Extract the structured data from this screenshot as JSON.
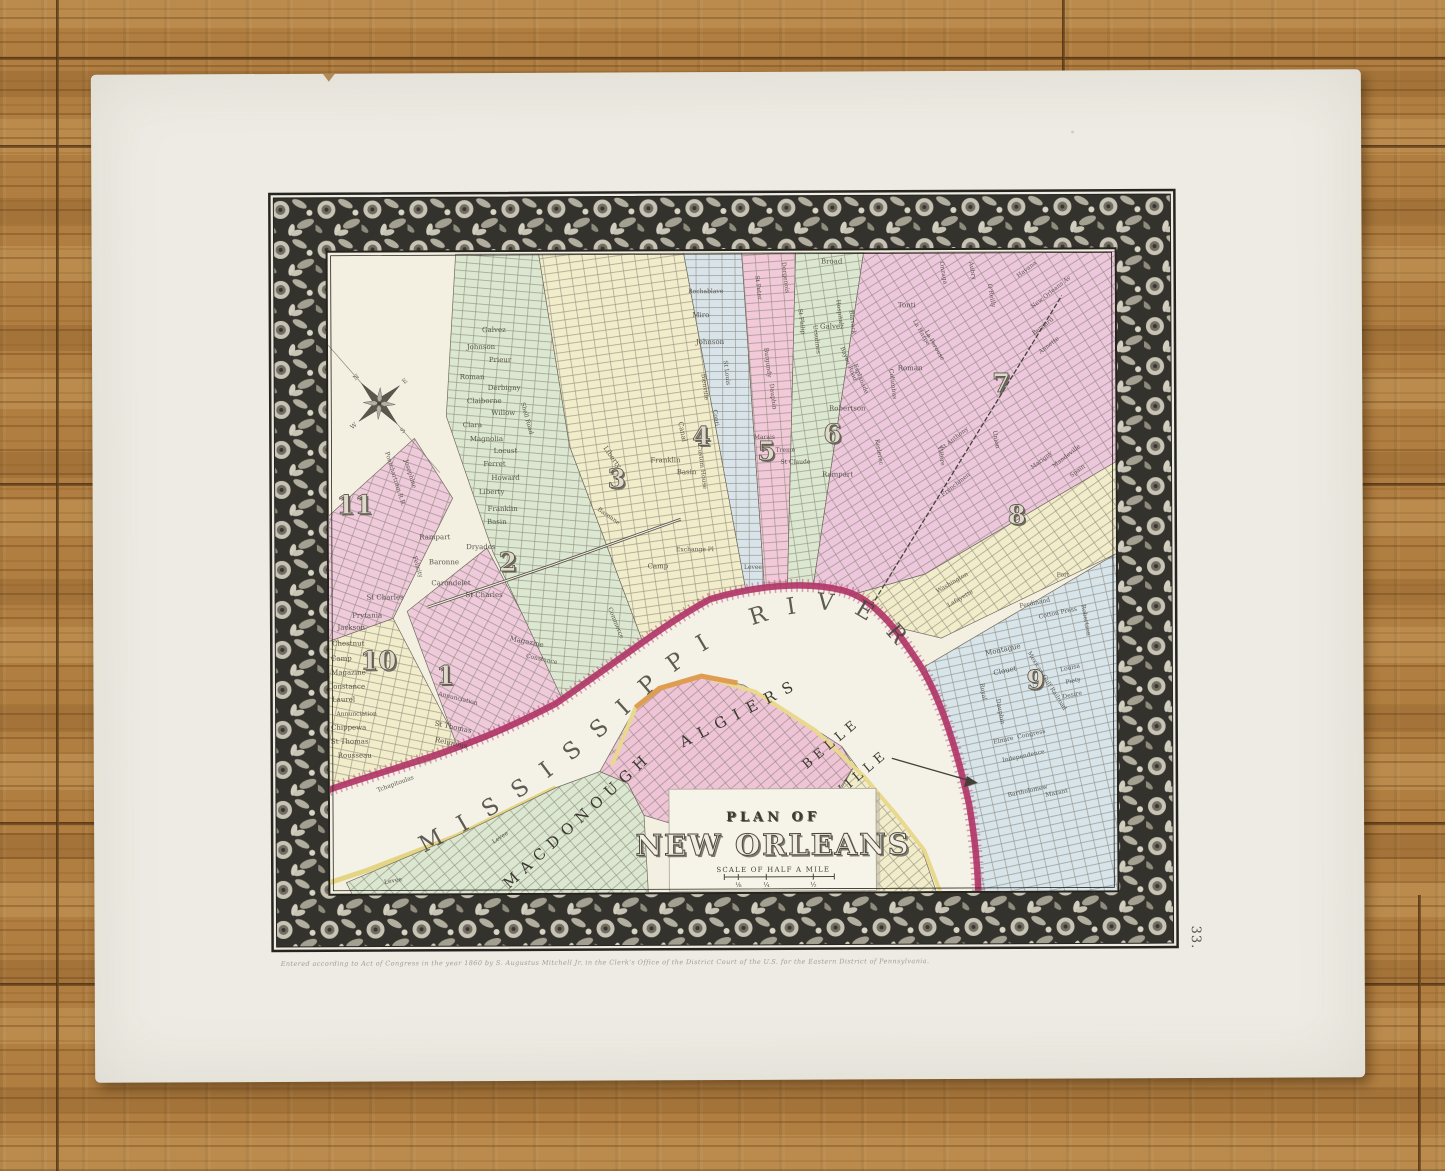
{
  "page": {
    "plate_number": "33.",
    "imprint": "Entered according to Act of Congress in the year 1860 by S. Augustus Mitchell Jr. in the Clerk's Office of the District Court of the U.S. for the Eastern District of Pennsylvania."
  },
  "cartouche": {
    "line1": "PLAN OF",
    "line2": "NEW ORLEANS",
    "scale_label": "SCALE OF HALF A MILE",
    "scale_fractions": [
      "⅛",
      "¼",
      "½"
    ]
  },
  "river": {
    "label": "MISSISSIPPI RIVER"
  },
  "compass_letters": [
    "N",
    "E",
    "S",
    "W"
  ],
  "area_labels": [
    {
      "t": "MACDONOUGH",
      "x": 585,
      "y": 828,
      "r": -42,
      "s": 15,
      "ls": 7
    },
    {
      "t": "ALGIERS",
      "x": 747,
      "y": 722,
      "r": -27,
      "s": 15,
      "ls": 9
    },
    {
      "t": "BELLE",
      "x": 838,
      "y": 752,
      "r": -40,
      "s": 13,
      "ls": 5
    },
    {
      "t": "VILLE",
      "x": 868,
      "y": 782,
      "r": -40,
      "s": 13,
      "ls": 5
    }
  ],
  "district_numbers": [
    {
      "n": "1",
      "x": 450,
      "y": 688
    },
    {
      "n": "2",
      "x": 513,
      "y": 575
    },
    {
      "n": "3",
      "x": 622,
      "y": 492
    },
    {
      "n": "4",
      "x": 707,
      "y": 450
    },
    {
      "n": "5",
      "x": 772,
      "y": 465
    },
    {
      "n": "6",
      "x": 838,
      "y": 448
    },
    {
      "n": "7",
      "x": 1007,
      "y": 398
    },
    {
      "n": "8",
      "x": 1022,
      "y": 530
    },
    {
      "n": "9",
      "x": 1040,
      "y": 695
    },
    {
      "n": "10",
      "x": 383,
      "y": 673
    },
    {
      "n": "11",
      "x": 360,
      "y": 517
    }
  ],
  "streets": [
    {
      "t": "Galvez",
      "x": 500,
      "y": 336
    },
    {
      "t": "Johnson",
      "x": 487,
      "y": 353
    },
    {
      "t": "Prieur",
      "x": 506,
      "y": 366
    },
    {
      "t": "Roman",
      "x": 478,
      "y": 383
    },
    {
      "t": "Derbigny",
      "x": 510,
      "y": 394
    },
    {
      "t": "Claiborne",
      "x": 490,
      "y": 407
    },
    {
      "t": "Willow",
      "x": 509,
      "y": 419
    },
    {
      "t": "Clara",
      "x": 478,
      "y": 431
    },
    {
      "t": "Magnolia",
      "x": 492,
      "y": 445
    },
    {
      "t": "Locust",
      "x": 511,
      "y": 457
    },
    {
      "t": "Ferret",
      "x": 500,
      "y": 470
    },
    {
      "t": "Howard",
      "x": 511,
      "y": 484
    },
    {
      "t": "Liberty",
      "x": 497,
      "y": 498
    },
    {
      "t": "Franklin",
      "x": 508,
      "y": 515
    },
    {
      "t": "Basin",
      "x": 502,
      "y": 528
    },
    {
      "t": "Shell Road",
      "x": 531,
      "y": 423,
      "r": 75,
      "s": 6
    },
    {
      "t": "Dryades",
      "x": 486,
      "y": 553
    },
    {
      "t": "Rampart",
      "x": 440,
      "y": 543
    },
    {
      "t": "Baronne",
      "x": 449,
      "y": 568
    },
    {
      "t": "Carondelet",
      "x": 456,
      "y": 589
    },
    {
      "t": "St Charles",
      "x": 489,
      "y": 601
    },
    {
      "t": "Pontchartrain R.R.",
      "x": 399,
      "y": 483,
      "r": 73,
      "s": 6
    },
    {
      "t": "Josephine",
      "x": 414,
      "y": 478,
      "r": 73,
      "s": 6
    },
    {
      "t": "Felicity",
      "x": 421,
      "y": 571,
      "r": 73,
      "s": 6
    },
    {
      "t": "Prytania",
      "x": 372,
      "y": 621
    },
    {
      "t": "St Charles",
      "x": 390,
      "y": 603
    },
    {
      "t": "Jackson",
      "x": 356,
      "y": 633
    },
    {
      "t": "Chestnut",
      "x": 353,
      "y": 649
    },
    {
      "t": "Camp",
      "x": 346,
      "y": 664
    },
    {
      "t": "Magazine",
      "x": 353,
      "y": 678
    },
    {
      "t": "Constance",
      "x": 351,
      "y": 692
    },
    {
      "t": "Laurel",
      "x": 348,
      "y": 705
    },
    {
      "t": "Annunciation",
      "x": 361,
      "y": 719,
      "s": 6
    },
    {
      "t": "Chippewa",
      "x": 353,
      "y": 733
    },
    {
      "t": "St Thomas",
      "x": 354,
      "y": 747
    },
    {
      "t": "Rousseau",
      "x": 359,
      "y": 761
    },
    {
      "t": "Tchapitoulas",
      "x": 400,
      "y": 789,
      "r": -20,
      "s": 6
    },
    {
      "t": "Religious",
      "x": 455,
      "y": 749,
      "r": 12
    },
    {
      "t": "St Thomas",
      "x": 457,
      "y": 733,
      "r": 12
    },
    {
      "t": "Annunciation",
      "x": 462,
      "y": 704,
      "r": 14,
      "s": 6
    },
    {
      "t": "Magazine",
      "x": 531,
      "y": 648,
      "r": 12
    },
    {
      "t": "Constance",
      "x": 546,
      "y": 665,
      "r": 12,
      "s": 6
    },
    {
      "t": "Camp",
      "x": 663,
      "y": 573
    },
    {
      "t": "Commerce",
      "x": 619,
      "y": 628,
      "r": 68,
      "s": 6
    },
    {
      "t": "Liberty",
      "x": 616,
      "y": 463,
      "r": 55
    },
    {
      "t": "Franklin",
      "x": 671,
      "y": 467
    },
    {
      "t": "Basin",
      "x": 692,
      "y": 479
    },
    {
      "t": "Canal",
      "x": 686,
      "y": 437,
      "r": 78
    },
    {
      "t": "Baronne",
      "x": 613,
      "y": 522,
      "r": 35,
      "s": 6
    },
    {
      "t": "Rochablave",
      "x": 712,
      "y": 298,
      "s": 6
    },
    {
      "t": "Miro",
      "x": 707,
      "y": 322
    },
    {
      "t": "Johnson",
      "x": 716,
      "y": 349
    },
    {
      "t": "St Louis",
      "x": 731,
      "y": 378,
      "r": 83,
      "s": 6
    },
    {
      "t": "Bienville",
      "x": 709,
      "y": 392,
      "r": 83,
      "s": 6
    },
    {
      "t": "Conti",
      "x": 720,
      "y": 423,
      "r": 83,
      "s": 6
    },
    {
      "t": "Custom House",
      "x": 706,
      "y": 472,
      "r": 83,
      "s": 6
    },
    {
      "t": "Exchange Pl",
      "x": 700,
      "y": 556,
      "s": 6
    },
    {
      "t": "Levee",
      "x": 758,
      "y": 574,
      "s": 6
    },
    {
      "t": "St Peter",
      "x": 763,
      "y": 293,
      "r": 83,
      "s": 6
    },
    {
      "t": "Burgundy",
      "x": 772,
      "y": 368,
      "r": 83,
      "s": 6
    },
    {
      "t": "Dauphin",
      "x": 777,
      "y": 402,
      "r": 83,
      "s": 6
    },
    {
      "t": "Marais",
      "x": 770,
      "y": 444,
      "s": 6
    },
    {
      "t": "Treme",
      "x": 791,
      "y": 457,
      "s": 6
    },
    {
      "t": "St Claude",
      "x": 801,
      "y": 469,
      "s": 6
    },
    {
      "t": "St Philip",
      "x": 806,
      "y": 327,
      "r": 83,
      "s": 6
    },
    {
      "t": "Ursulines",
      "x": 821,
      "y": 345,
      "r": 83,
      "s": 6
    },
    {
      "t": "Broad",
      "x": 838,
      "y": 269
    },
    {
      "t": "Hospital",
      "x": 844,
      "y": 318,
      "r": 83,
      "s": 6
    },
    {
      "t": "Barrack",
      "x": 857,
      "y": 328,
      "r": 83,
      "s": 6
    },
    {
      "t": "Galvez",
      "x": 838,
      "y": 334
    },
    {
      "t": "Bayou Road",
      "x": 853,
      "y": 370,
      "r": 68,
      "s": 6
    },
    {
      "t": "Esplanade",
      "x": 865,
      "y": 385,
      "r": 68,
      "s": 6
    },
    {
      "t": "Robertson",
      "x": 853,
      "y": 416
    },
    {
      "t": "Rampart",
      "x": 843,
      "y": 482
    },
    {
      "t": "Kerlerec",
      "x": 883,
      "y": 458,
      "r": 80,
      "s": 6
    },
    {
      "t": "Dorgenois",
      "x": 790,
      "y": 283,
      "r": 83,
      "s": 6
    },
    {
      "t": "Tonti",
      "x": 913,
      "y": 313
    },
    {
      "t": "Roman",
      "x": 916,
      "y": 376
    },
    {
      "t": "Columbus",
      "x": 897,
      "y": 390,
      "r": 83,
      "s": 6
    },
    {
      "t": "La Harpe",
      "x": 926,
      "y": 339,
      "r": 60,
      "s": 6
    },
    {
      "t": "La Perouse",
      "x": 939,
      "y": 352,
      "r": 60,
      "s": 6
    },
    {
      "t": "Onzaga",
      "x": 948,
      "y": 279,
      "r": 80,
      "s": 6
    },
    {
      "t": "Aubry",
      "x": 977,
      "y": 277,
      "r": 80,
      "s": 6
    },
    {
      "t": "O'Reilly",
      "x": 996,
      "y": 302,
      "r": 80,
      "s": 6
    },
    {
      "t": "Havana",
      "x": 1034,
      "y": 277,
      "r": -38,
      "s": 6
    },
    {
      "t": "New Orleans Av",
      "x": 1058,
      "y": 300,
      "r": -38,
      "s": 6
    },
    {
      "t": "Bernard",
      "x": 1050,
      "y": 334,
      "r": -38,
      "s": 6
    },
    {
      "t": "Annette",
      "x": 1056,
      "y": 353,
      "r": -38,
      "s": 6
    },
    {
      "t": "St Anthony",
      "x": 961,
      "y": 446,
      "r": -38,
      "s": 6
    },
    {
      "t": "Villere",
      "x": 945,
      "y": 462,
      "r": 80,
      "s": 6
    },
    {
      "t": "Frenchmen",
      "x": 962,
      "y": 492,
      "r": -38,
      "s": 6
    },
    {
      "t": "Marigny",
      "x": 1048,
      "y": 468,
      "r": -38,
      "s": 6
    },
    {
      "t": "Mandeville",
      "x": 1073,
      "y": 464,
      "r": -38,
      "s": 6
    },
    {
      "t": "Spain",
      "x": 1084,
      "y": 479,
      "r": -38,
      "s": 6
    },
    {
      "t": "Union",
      "x": 1000,
      "y": 446,
      "r": 80,
      "s": 6
    },
    {
      "t": "Washington",
      "x": 958,
      "y": 590,
      "r": -30,
      "s": 6
    },
    {
      "t": "Lafayette",
      "x": 966,
      "y": 606,
      "r": -30,
      "s": 6
    },
    {
      "t": "Port",
      "x": 1068,
      "y": 583,
      "s": 6
    },
    {
      "t": "Ferdinand",
      "x": 1040,
      "y": 611,
      "r": -12,
      "s": 6
    },
    {
      "t": "Cotton Press",
      "x": 1063,
      "y": 621,
      "r": -12,
      "s": 6
    },
    {
      "t": "Montague",
      "x": 1008,
      "y": 658,
      "r": -12
    },
    {
      "t": "Clouet",
      "x": 1010,
      "y": 679,
      "r": -12
    },
    {
      "t": "Louisa",
      "x": 1075,
      "y": 676,
      "r": -12,
      "s": 6
    },
    {
      "t": "Piety",
      "x": 1078,
      "y": 689,
      "r": -12,
      "s": 6
    },
    {
      "t": "Desire",
      "x": 1077,
      "y": 703,
      "r": -12,
      "s": 6
    },
    {
      "t": "Elmire",
      "x": 1008,
      "y": 748,
      "r": -12,
      "s": 6
    },
    {
      "t": "Congress",
      "x": 1036,
      "y": 742,
      "r": -12,
      "s": 6
    },
    {
      "t": "Independence",
      "x": 1028,
      "y": 764,
      "r": -12,
      "s": 6
    },
    {
      "t": "Bartholomew",
      "x": 1032,
      "y": 799,
      "r": -12,
      "s": 6
    },
    {
      "t": "Mazant",
      "x": 1061,
      "y": 801,
      "r": -12,
      "s": 6
    },
    {
      "t": "Royal",
      "x": 986,
      "y": 698,
      "r": 80,
      "s": 6
    },
    {
      "t": "Dauphin",
      "x": 1003,
      "y": 718,
      "r": 80,
      "s": 6
    },
    {
      "t": "Mexican Gulf Railroad",
      "x": 1050,
      "y": 688,
      "r": 58,
      "s": 6
    },
    {
      "t": "Robertson",
      "x": 1089,
      "y": 627,
      "r": 80,
      "s": 6
    },
    {
      "t": "Levee",
      "x": 397,
      "y": 886,
      "r": -10,
      "s": 6
    },
    {
      "t": "Levee",
      "x": 505,
      "y": 843,
      "r": -33,
      "s": 6
    }
  ],
  "colors": {
    "pink": "#eecadb",
    "green": "#dbe7d0",
    "cream": "#f1ecca",
    "blue": "#d9e4ea",
    "river_bank_crimson": "#b23769",
    "levee_yellow": "#e4d584",
    "orange": "#df9d52",
    "paper": "#edebe3",
    "wood": "#b07e40",
    "border_band": "#34322c"
  }
}
